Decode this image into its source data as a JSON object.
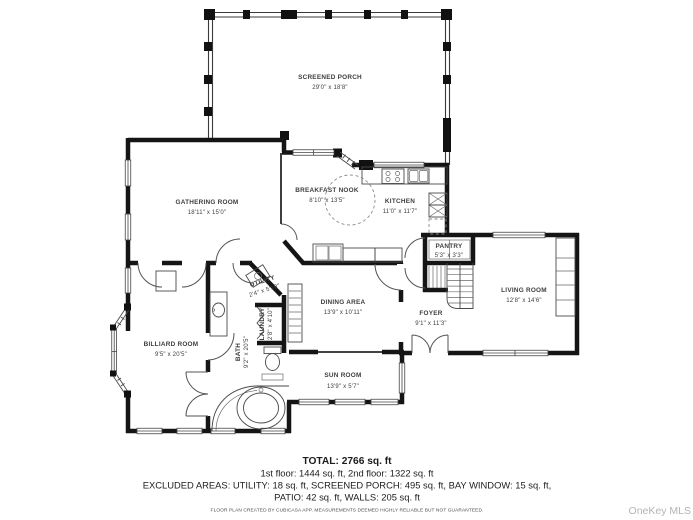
{
  "watermark": "OneKey MLS",
  "colors": {
    "wall": "#151515",
    "thin_line": "#4a4a4a",
    "label": "#3d3d3d",
    "watermark": "#b4b4b4"
  },
  "rooms": [
    {
      "id": "screened-porch",
      "name": "SCREENED PORCH",
      "dims": "29'0\" x 18'8\""
    },
    {
      "id": "gathering-room",
      "name": "GATHERING ROOM",
      "dims": "18'11\" x 15'0\""
    },
    {
      "id": "breakfast-nook",
      "name": "BREAKFAST NOOK",
      "dims": "8'10\" x 13'5\""
    },
    {
      "id": "kitchen",
      "name": "KITCHEN",
      "dims": "11'0\" x 11'7\""
    },
    {
      "id": "pantry",
      "name": "PANTRY",
      "dims": "5'3\" x 3'3\""
    },
    {
      "id": "living-room",
      "name": "LIVING ROOM",
      "dims": "12'8\" x 14'6\""
    },
    {
      "id": "dining-area",
      "name": "DINING AREA",
      "dims": "13'9\" x 10'11\""
    },
    {
      "id": "foyer",
      "name": "FOYER",
      "dims": "9'1\" x 11'3\""
    },
    {
      "id": "sun-room",
      "name": "SUN ROOM",
      "dims": "13'9\" x 5'7\""
    },
    {
      "id": "billiard-room",
      "name": "BILLIARD ROOM",
      "dims": "9'5\" x 20'5\""
    },
    {
      "id": "utility",
      "name": "UTILITY",
      "dims": "2'4\" x 5'10\""
    },
    {
      "id": "laundry",
      "name": "LAUNDRY",
      "dims": "2'8\" x 4'10\""
    },
    {
      "id": "bath",
      "name": "BATH",
      "dims": "9'2\" x 20'5\""
    }
  ],
  "summary": {
    "total": "TOTAL: 2766 sq. ft",
    "floors": "1st floor: 1444 sq. ft, 2nd floor: 1322 sq. ft",
    "excluded_line1": "EXCLUDED AREAS: UTILITY: 18 sq. ft, SCREENED PORCH: 495 sq. ft, BAY WINDOW: 15 sq. ft,",
    "excluded_line2": "PATIO: 42 sq. ft, WALLS: 205 sq. ft",
    "disclaimer": "FLOOR PLAN CREATED BY CUBICASA APP. MEASUREMENTS DEEMED HIGHLY RELIABLE BUT NOT GUARANTEED."
  }
}
